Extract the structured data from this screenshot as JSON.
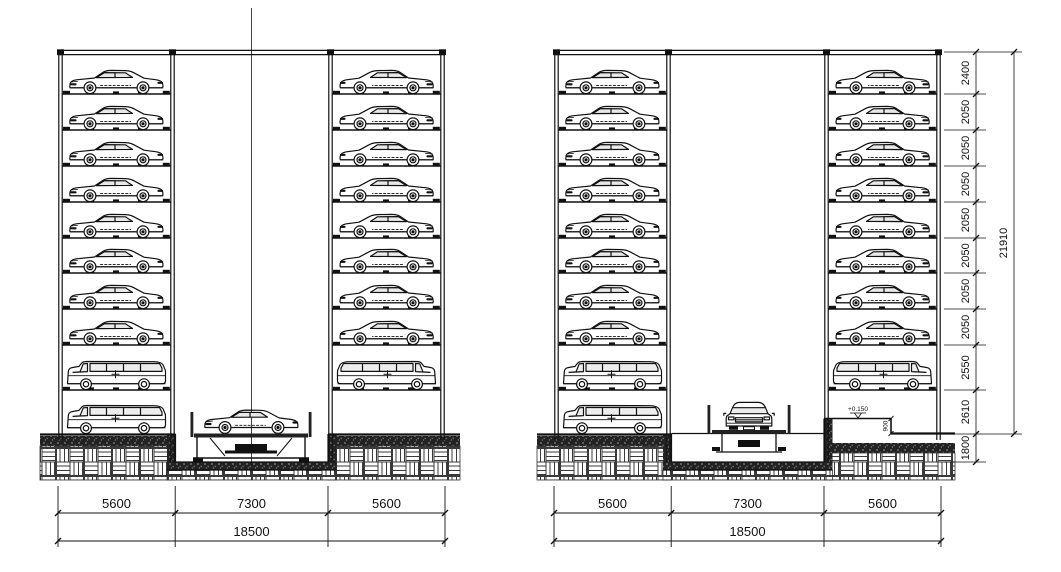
{
  "drawing": {
    "background": "#ffffff",
    "line_color": "#111111",
    "views": [
      {
        "name": "left-section",
        "towers": {
          "left": [
            "sedan",
            "sedan",
            "sedan",
            "sedan",
            "sedan",
            "sedan",
            "sedan",
            "sedan",
            "van",
            "van"
          ],
          "right": [
            "sedan",
            "sedan",
            "sedan",
            "sedan",
            "sedan",
            "sedan",
            "sedan",
            "sedan",
            "van",
            "empty"
          ]
        },
        "lift": {
          "vehicle": "sedan-side",
          "location": "pit-bottom"
        },
        "dims_bottom": {
          "segments": [
            "5600",
            "7300",
            "5600"
          ],
          "total": "18500"
        }
      },
      {
        "name": "right-section",
        "towers": {
          "left": [
            "sedan",
            "sedan",
            "sedan",
            "sedan",
            "sedan",
            "sedan",
            "sedan",
            "sedan",
            "van",
            "van"
          ],
          "right": [
            "sedan",
            "sedan",
            "sedan",
            "sedan",
            "sedan",
            "sedan",
            "sedan",
            "sedan",
            "van",
            "empty"
          ]
        },
        "lift": {
          "vehicle": "car-front",
          "location": "ground-level"
        },
        "dims_bottom": {
          "segments": [
            "5600",
            "7300",
            "5600"
          ],
          "total": "18500"
        },
        "dims_right": {
          "levels": [
            "2400",
            "2050",
            "2050",
            "2050",
            "2050",
            "2050",
            "2050",
            "2050",
            "2550",
            "2610",
            "1800"
          ],
          "total": "21910"
        },
        "annotations": {
          "level_marker": "+0.150",
          "edge_dim": "900"
        }
      }
    ]
  }
}
